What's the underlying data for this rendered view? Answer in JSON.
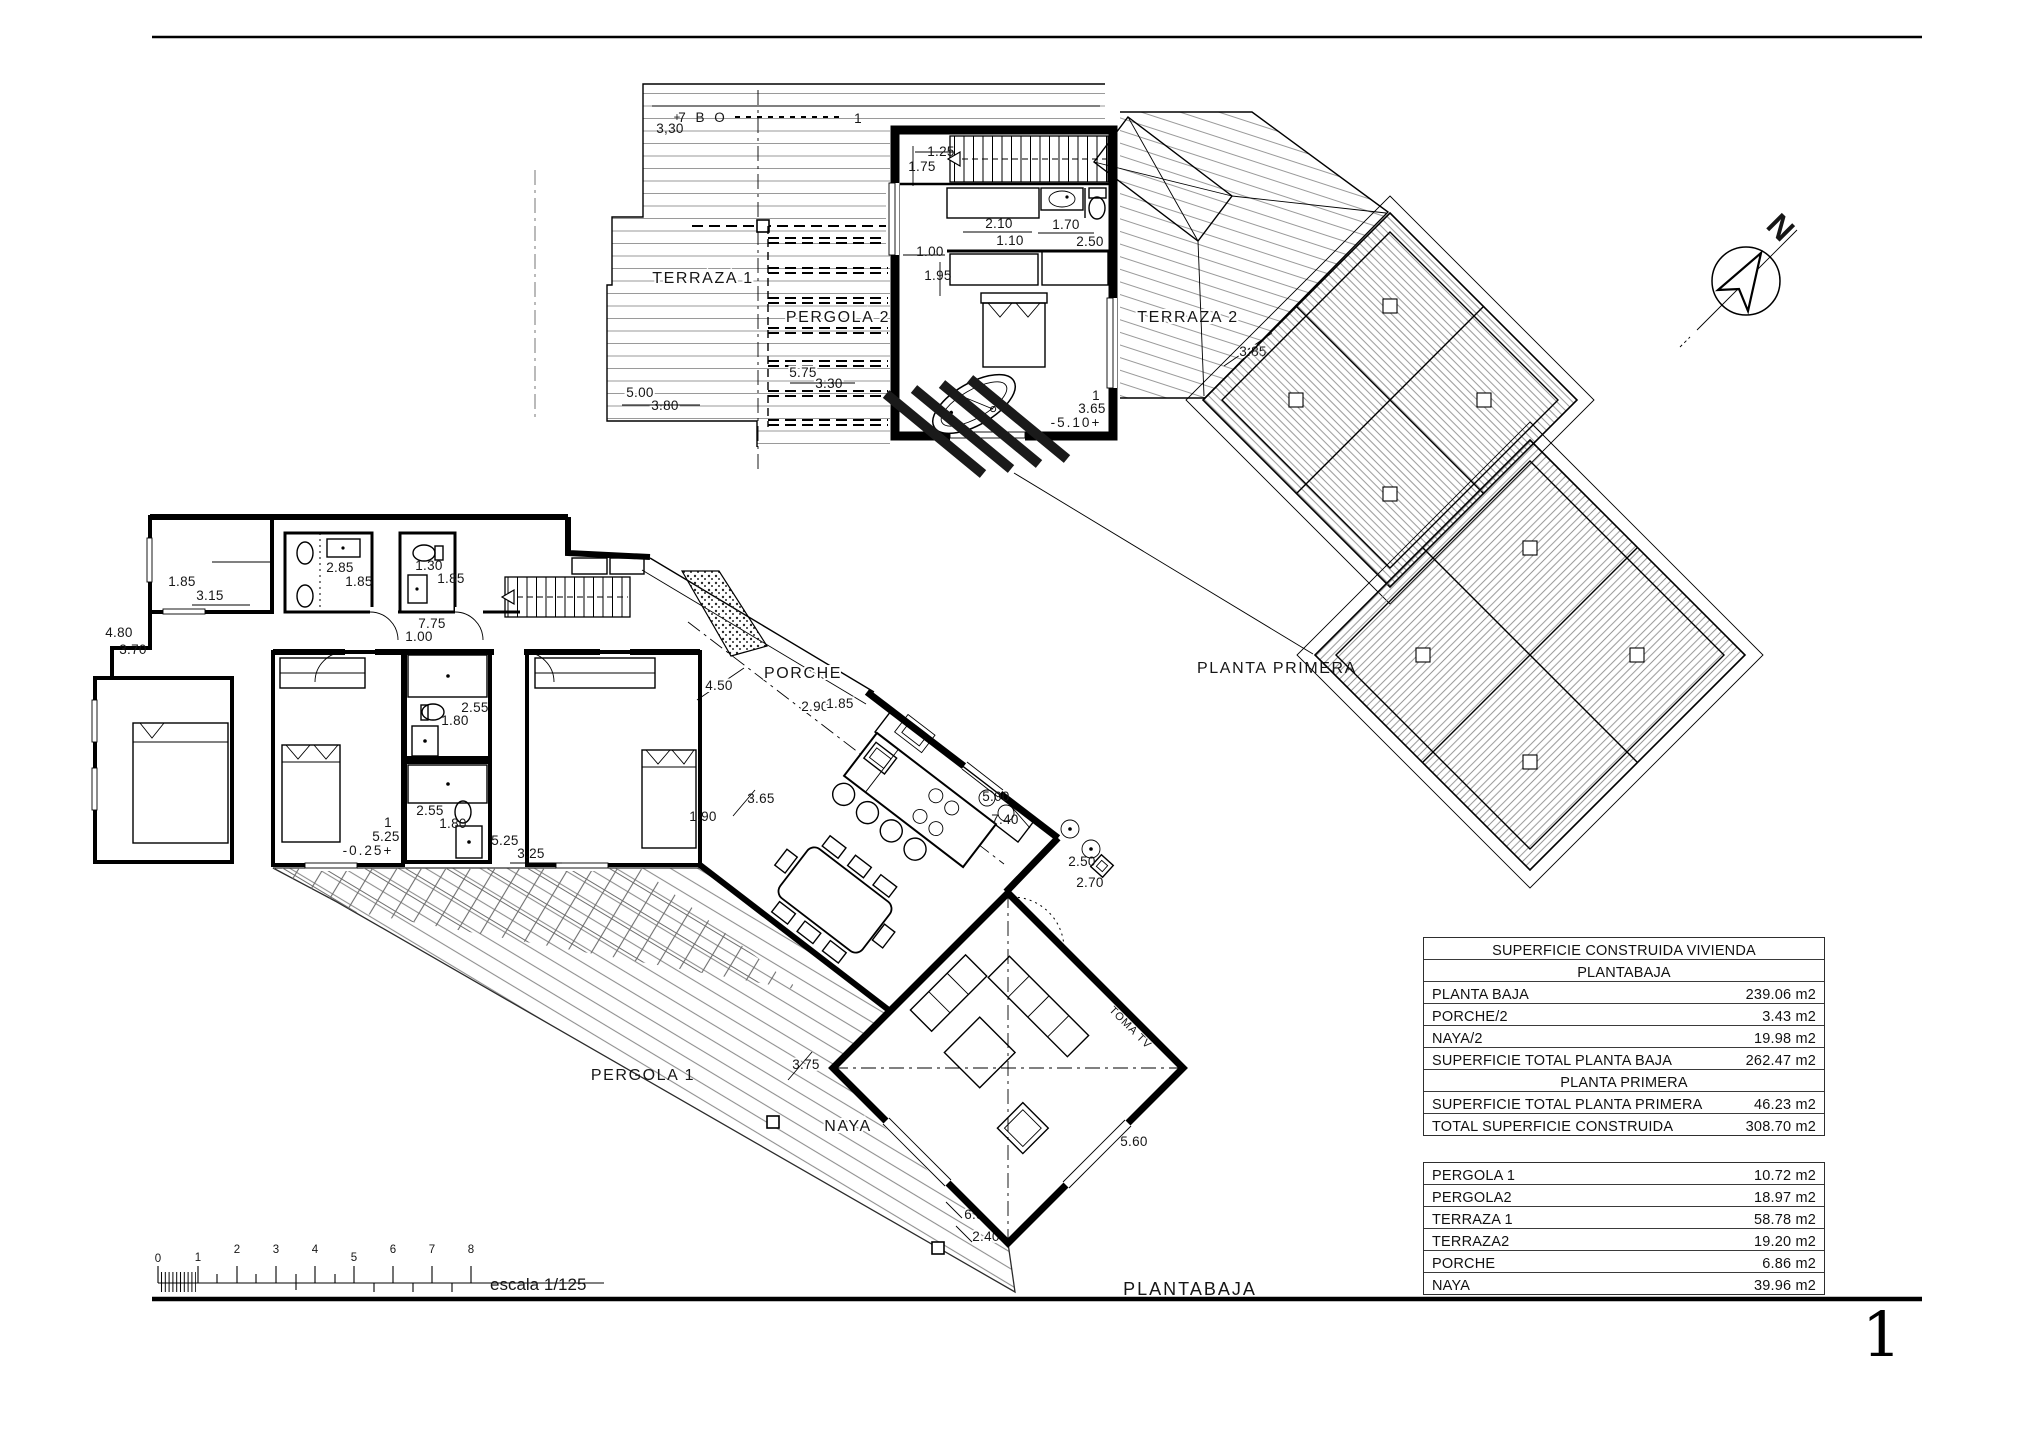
{
  "page": {
    "number": "1"
  },
  "north": {
    "label": "N"
  },
  "scale_bar": {
    "ticks": [
      "0",
      "1",
      "2",
      "3",
      "4",
      "5",
      "6",
      "7",
      "8"
    ],
    "label": "escala  1/125"
  },
  "labels": {
    "terraza1": "TERRAZA 1",
    "pergola2": "PERGOLA 2",
    "terraza2": "TERRAZA 2",
    "planta_primera": "PLANTA PRIMERA",
    "porche": "PORCHE",
    "pergola1": "PERGOLA 1",
    "naya": "NAYA",
    "plantabaja": "PLANTABAJA",
    "toma_tv": "TOMA TV"
  },
  "annotations": {
    "level_top": "3,30",
    "plus": "+",
    "ref_top": "7 B O",
    "ref_num": "1",
    "ff_num": "1",
    "level_ff": "-5.10+",
    "gf_num": "1",
    "level_gf": "-0.25+"
  },
  "dims": {
    "terraza1": [
      "5.00",
      "3.80"
    ],
    "pergola2": [
      "5.75",
      "3.30"
    ],
    "terraza2": "3.85",
    "first_floor": [
      "1.25",
      "1.75",
      "2.10",
      "1.10",
      "1.70",
      "2.50",
      "1.00",
      "1.95",
      "3.65"
    ],
    "gf": {
      "left_room": [
        "1.85",
        "3.15"
      ],
      "bed3": [
        "4.80",
        "3.70"
      ],
      "bath1": [
        "2.85",
        "1.85"
      ],
      "bath2": [
        "1.30",
        "1.85"
      ],
      "hall_top": [
        "7.75",
        "1.00"
      ],
      "bath_mid": [
        "2.55",
        "1.80"
      ],
      "bath_low": [
        "2.55",
        "1.80"
      ],
      "bed1": [
        "5.25"
      ],
      "bed2": [
        "5.25",
        "3.25"
      ],
      "porch": [
        "4.50",
        "2.90",
        "1.85"
      ],
      "hall": [
        "3.65",
        "1.90",
        "5.00",
        "7.40"
      ],
      "kitchen_end": [
        "2.50",
        "2.70"
      ],
      "deck": [
        "3.75",
        "7.70",
        "5.60",
        "6.55",
        "2.40"
      ]
    }
  },
  "tables": {
    "construida": {
      "title": "SUPERFICIE CONSTRUIDA VIVIENDA",
      "rows": [
        {
          "label": "PLANTABAJA",
          "value": ""
        },
        {
          "label": "PLANTA BAJA",
          "value": "239.06 m2"
        },
        {
          "label": "PORCHE/2",
          "value": "3.43 m2"
        },
        {
          "label": "NAYA/2",
          "value": "19.98 m2"
        },
        {
          "label": "SUPERFICIE TOTAL PLANTA BAJA",
          "value": "262.47 m2"
        },
        {
          "label": "PLANTA PRIMERA",
          "value": ""
        },
        {
          "label": "SUPERFICIE TOTAL PLANTA PRIMERA",
          "value": "46.23 m2"
        },
        {
          "label": "TOTAL  SUPERFICIE CONSTRUIDA",
          "value": "308.70 m2"
        }
      ]
    },
    "exteriores": {
      "rows": [
        {
          "label": "PERGOLA 1",
          "value": "10.72 m2"
        },
        {
          "label": "PERGOLA2",
          "value": "18.97 m2"
        },
        {
          "label": "TERRAZA 1",
          "value": "58.78 m2"
        },
        {
          "label": "TERRAZA2",
          "value": "19.20 m2"
        },
        {
          "label": "PORCHE",
          "value": "6.86 m2"
        },
        {
          "label": "NAYA",
          "value": "39.96 m2"
        }
      ]
    }
  }
}
